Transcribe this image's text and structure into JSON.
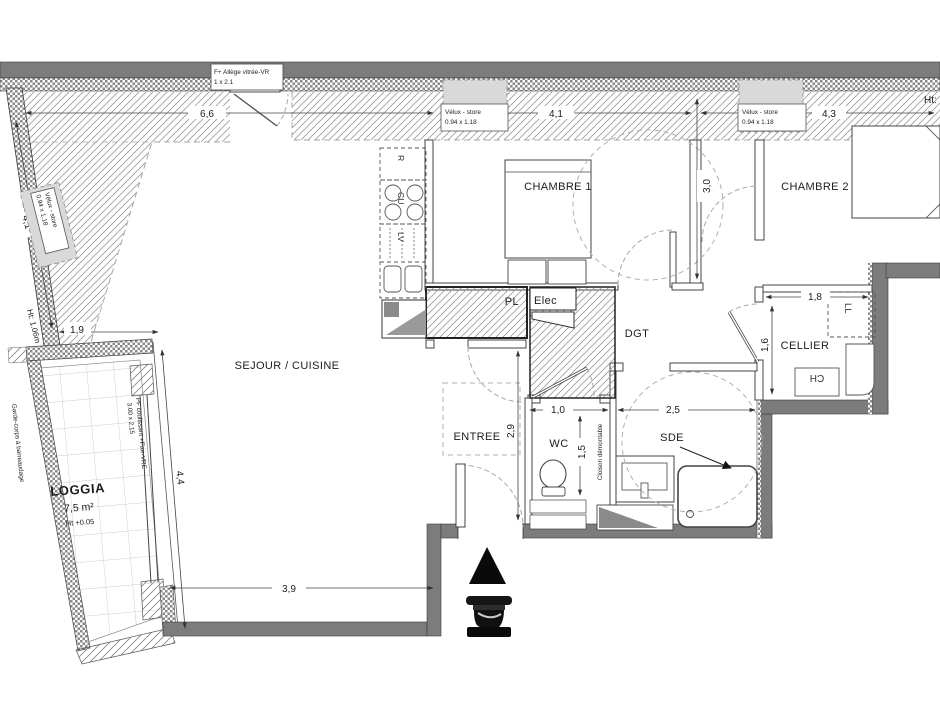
{
  "rooms": {
    "sejour": {
      "label": "SEJOUR / CUISINE"
    },
    "chambre1": {
      "label": "CHAMBRE 1"
    },
    "chambre2": {
      "label": "CHAMBRE 2"
    },
    "entree": {
      "label": "ENTREE"
    },
    "wc": {
      "label": "WC"
    },
    "sde": {
      "label": "SDE"
    },
    "dgt": {
      "label": "DGT"
    },
    "cellier": {
      "label": "CELLIER"
    },
    "pl": {
      "label": "PL"
    },
    "loggia": {
      "label": "LOGGIA",
      "area": "7,5 m²",
      "height_note": "Ht +0.05"
    }
  },
  "equipment": {
    "fridge": "R",
    "cooktop": "CU",
    "dishwasher": "LV",
    "washer": "LL",
    "water_heater": "CH",
    "elec": "Elec"
  },
  "openings": {
    "window_top": {
      "line1": "F+ Allège vitrée-VR",
      "line2": "1 x 2.1"
    },
    "velux1": {
      "line1": "Vélux - store",
      "line2": "0.94 x 1.18"
    },
    "velux2": {
      "line1": "Vélux - store",
      "line2": "0.94 x 1.18"
    },
    "velux3": {
      "line1": "Vélux - store",
      "line2": "0.94 x 1.18"
    },
    "bay": {
      "line1": "PF coulissant +Fixe-VRE",
      "line2": "3.00 x 2.15"
    },
    "railing": "Garde-corps à barreaudage",
    "partition": "Cloison démontable"
  },
  "notes": {
    "ht_left": "Ht: 1.06m",
    "ht_right": "Ht:"
  },
  "dims": {
    "top_left": "6,6",
    "top_mid": "4,1",
    "top_right": "4,3",
    "chambre1_depth": "3,0",
    "slant": "4,1",
    "nook": "1,9",
    "loggia_side": "4,4",
    "sejour_bottom": "3,9",
    "entree_depth": "2,9",
    "wc_width": "1,0",
    "wc_depth": "1,5",
    "sde_width": "2,5",
    "cellier_width": "1,8",
    "cellier_depth": "1,6"
  },
  "colors": {
    "wall": "#7c7c7c",
    "hatch_line": "#9b9b9b",
    "dashed": "#a8a8a8",
    "line": "#333333"
  }
}
